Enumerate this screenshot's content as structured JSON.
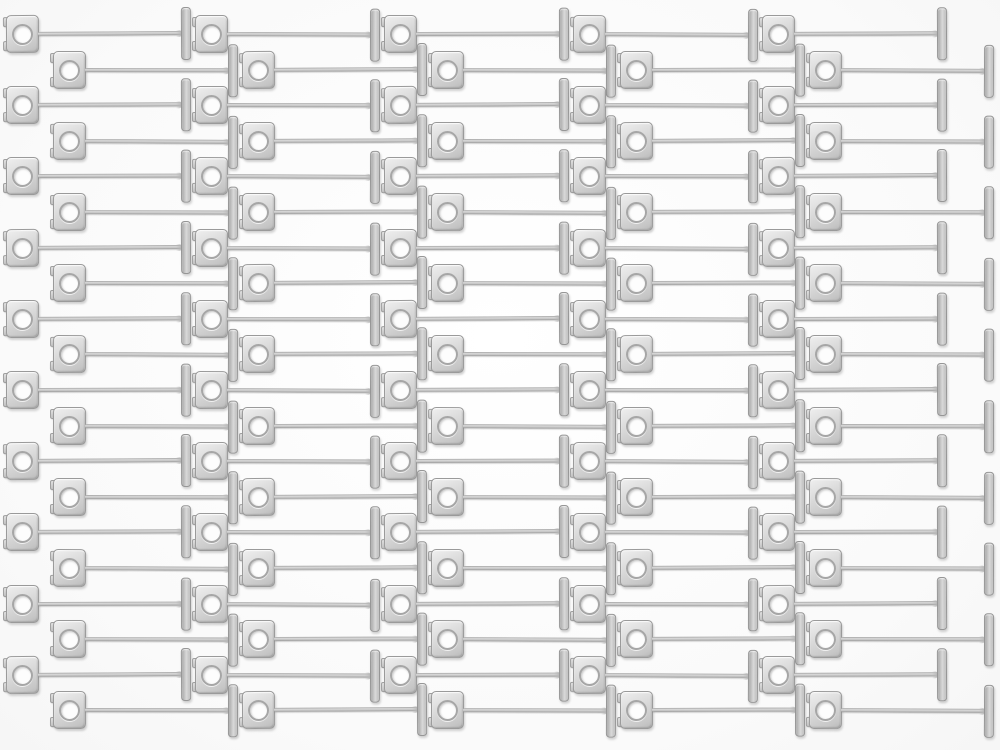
{
  "scene": {
    "subject": "loose metal T-pin fasteners laid out in staggered interlocking rows on a white surface",
    "object_kind": "t-pin-fastener",
    "item_count": 100,
    "rows": 20,
    "clips_per_row": 5,
    "background_color": "#fafafa"
  },
  "geometry": {
    "row_start_y": 34,
    "row_pitch_y": 35.6,
    "row_a_start_x": 22,
    "row_b_start_x": 69,
    "clip_pitch_x": 189,
    "tbar_offset_x": 163,
    "plate_w": 33,
    "plate_h": 38,
    "hole_d": 21,
    "shaft_len": 143.5,
    "shaft_thickness": 4.6,
    "tbar_w": 9.5,
    "tbar_h": 53,
    "rotation_jitter_deg": [
      -0.35,
      0.2,
      -0.15,
      0.3,
      -0.25,
      0.1
    ]
  },
  "palette": {
    "metal_highlight": "#efefef",
    "metal_mid": "#cfcfcf",
    "metal_shadow": "#a0a0a0",
    "edge": "#9a9a9a",
    "hole_fill": "#fdfdfd",
    "background": "#fafafa"
  }
}
